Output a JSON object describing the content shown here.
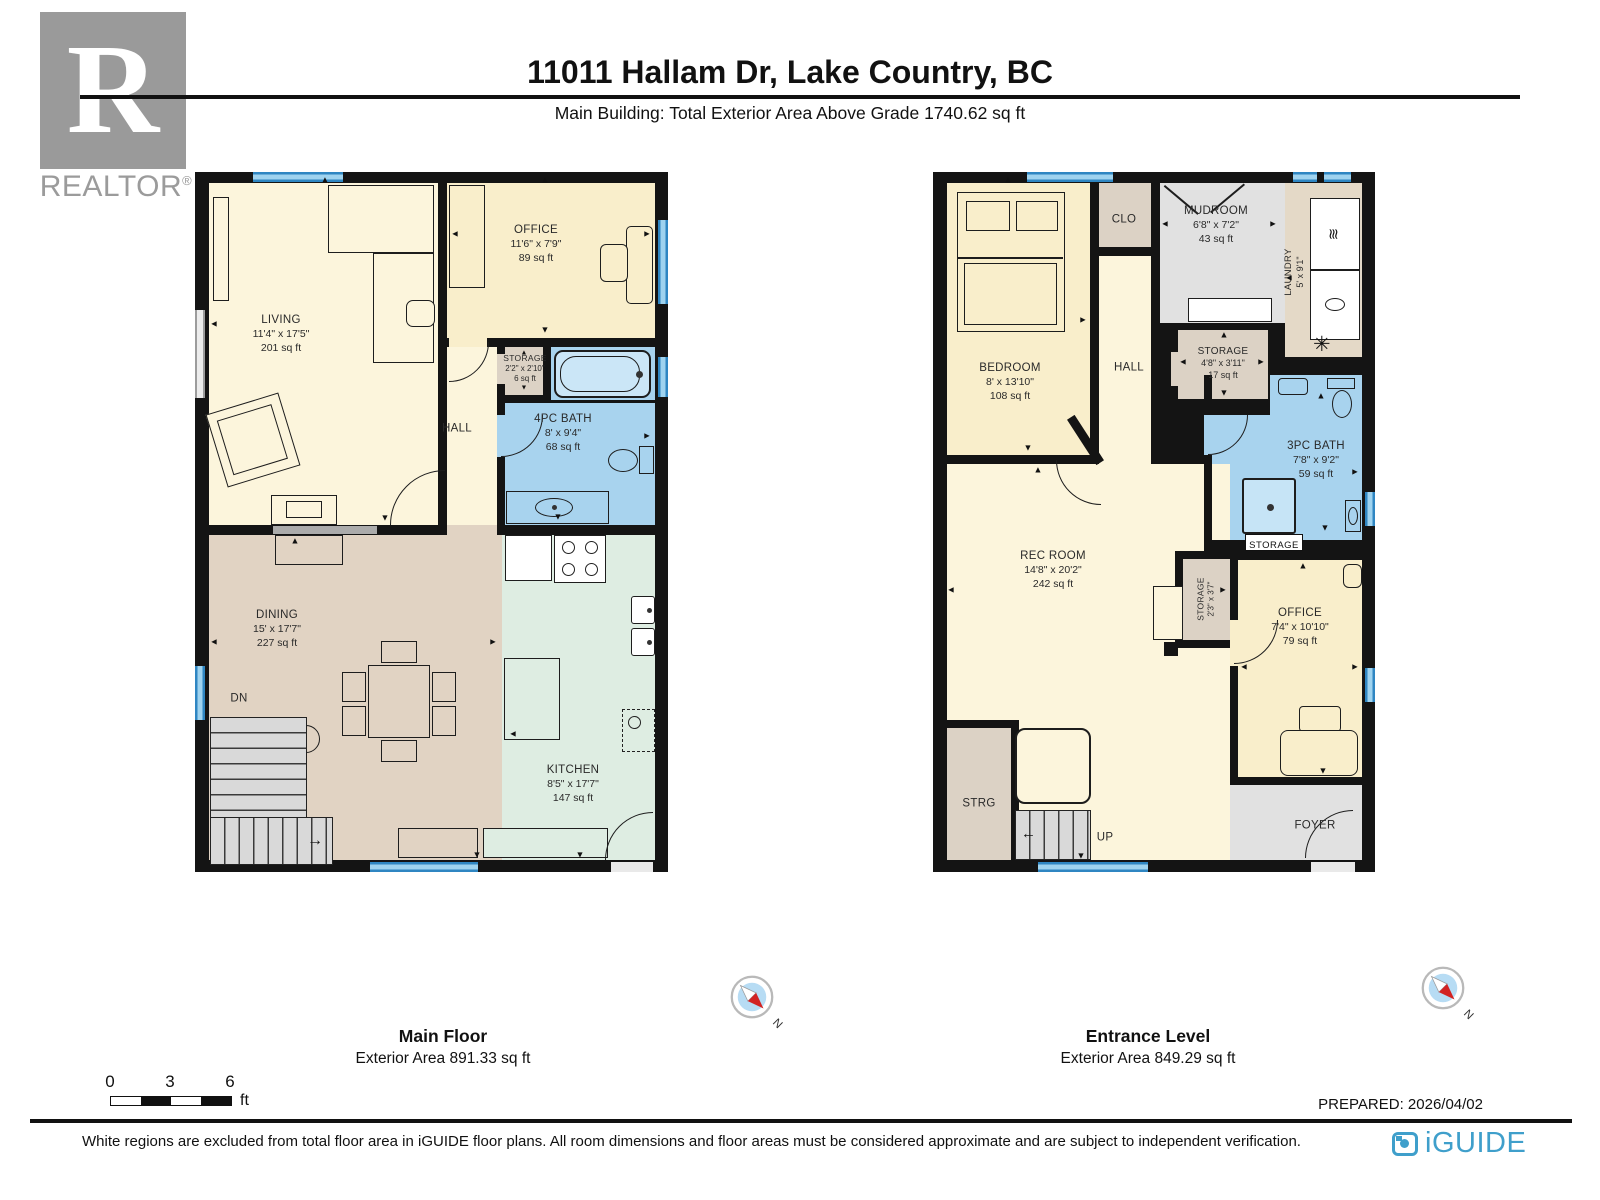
{
  "header": {
    "logo_text": "REALTOR",
    "logo_reg": "®",
    "logo_r": "R",
    "title": "11011 Hallam Dr, Lake Country, BC",
    "subtitle": "Main Building: Total Exterior Area Above Grade 1740.62 sq ft"
  },
  "floors": {
    "main": {
      "title": "Main Floor",
      "area": "Exterior Area 891.33 sq ft",
      "rooms": {
        "living": {
          "name": "LIVING",
          "dims": "11'4\" x 17'5\"",
          "area": "201 sq ft"
        },
        "office": {
          "name": "OFFICE",
          "dims": "11'6\" x 7'9\"",
          "area": "89 sq ft"
        },
        "storage": {
          "name": "STORAGE",
          "dims": "2'2\" x 2'10\"",
          "area": "6 sq ft"
        },
        "hall": {
          "name": "HALL"
        },
        "bath": {
          "name": "4PC BATH",
          "dims": "8' x 9'4\"",
          "area": "68 sq ft"
        },
        "dining": {
          "name": "DINING",
          "dims": "15' x 17'7\"",
          "area": "227 sq ft"
        },
        "kitchen": {
          "name": "KITCHEN",
          "dims": "8'5\" x 17'7\"",
          "area": "147 sq ft"
        },
        "stairs": {
          "name": "DN"
        }
      }
    },
    "entrance": {
      "title": "Entrance Level",
      "area": "Exterior Area 849.29 sq ft",
      "rooms": {
        "bedroom": {
          "name": "BEDROOM",
          "dims": "8' x 13'10\"",
          "area": "108 sq ft"
        },
        "clo": {
          "name": "CLO"
        },
        "mudroom": {
          "name": "MUDROOM",
          "dims": "6'8\" x 7'2\"",
          "area": "43 sq ft"
        },
        "laundry": {
          "name": "LAUNDRY",
          "dims": "5' x 9'1\""
        },
        "hall": {
          "name": "HALL"
        },
        "storage1": {
          "name": "STORAGE",
          "dims": "4'8\" x 3'11\"",
          "area": "17 sq ft"
        },
        "bath": {
          "name": "3PC BATH",
          "dims": "7'8\" x 9'2\"",
          "area": "59 sq ft"
        },
        "storage2": {
          "name": "STORAGE"
        },
        "recroom": {
          "name": "REC ROOM",
          "dims": "14'8\" x 20'2\"",
          "area": "242 sq ft"
        },
        "storage3": {
          "name": "STORAGE",
          "dims": "2'3\" x 3'7\""
        },
        "office": {
          "name": "OFFICE",
          "dims": "7'4\" x 10'10\"",
          "area": "79 sq ft"
        },
        "strg": {
          "name": "STRG"
        },
        "stairs": {
          "name": "UP"
        },
        "foyer": {
          "name": "FOYER"
        }
      }
    }
  },
  "compass": {
    "label": "N"
  },
  "scale": {
    "t0": "0",
    "t1": "3",
    "t2": "6",
    "unit": "ft"
  },
  "footer": {
    "prepared": "PREPARED: 2026/04/02",
    "disclaimer": "White regions are excluded from total floor area in iGUIDE floor plans. All room dimensions and floor areas must be considered approximate and are subject to independent verification.",
    "brand": "iGUIDE"
  },
  "colors": {
    "wall": "#141414",
    "floor_cream": "#FCF5DC",
    "floor_yellow": "#F9EECB",
    "floor_tan": "#E1D3C3",
    "floor_mint": "#DEEDE2",
    "floor_blue": "#A8D3EE",
    "floor_gray": "#E1E1E1",
    "floor_storage": "#DCD2C5",
    "window_blue": "#2F86C2",
    "brand_blue": "#3F9FCB",
    "compass_red": "#D22222"
  }
}
